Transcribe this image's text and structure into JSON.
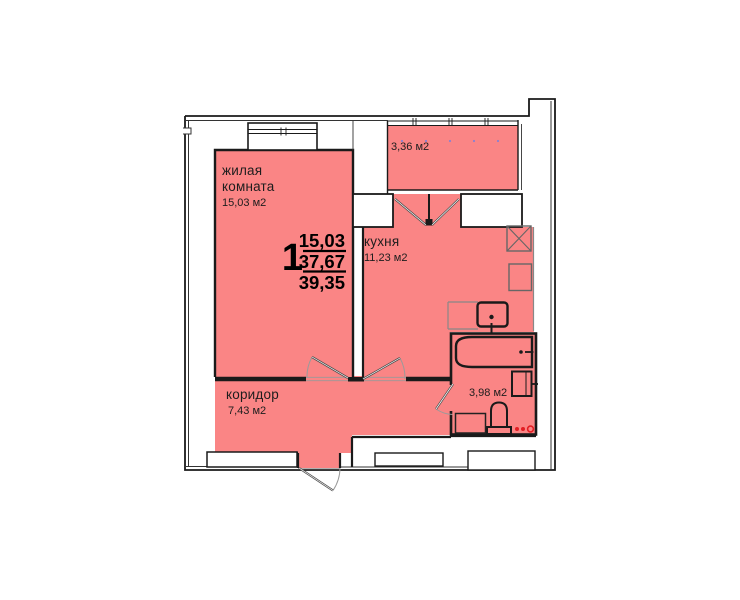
{
  "summary": {
    "rooms_count": "1",
    "living_area": "15,03",
    "total_area": "37,67",
    "overall_area": "39,35"
  },
  "rooms": {
    "living": {
      "name_line1": "жилая",
      "name_line2": "комната",
      "area": "15,03 м2"
    },
    "kitchen": {
      "name": "кухня",
      "area": "11,23 м2"
    },
    "corridor": {
      "name": "коридор",
      "area": "7,43 м2"
    },
    "bathroom": {
      "area": "3,98 м2"
    },
    "balcony": {
      "area": "3,36 м2"
    }
  },
  "colors": {
    "floor_pink": "#fa8585",
    "wall_black": "#1a1a1a",
    "counter_gray": "#888888",
    "accent_red": "#e31e24",
    "window_dot_blue": "#8080d8"
  }
}
